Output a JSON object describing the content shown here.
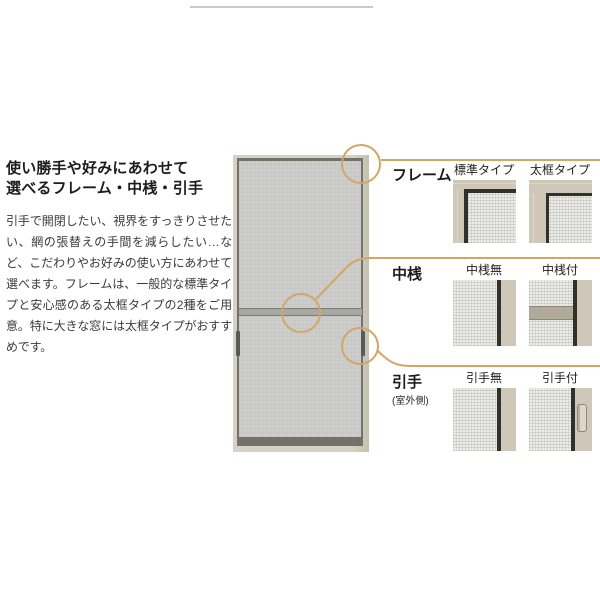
{
  "intro": {
    "title_line1": "使い勝手や好みにあわせて",
    "title_line2": "選べるフレーム・中桟・引手",
    "body": "引手で開閉したい、視界をすっきりさせたい、網の張替えの手間を減らしたい…など、こだわりやお好みの使い方にあわせて選べます。フレームは、一般的な標準タイプと安心感のある太框タイプの2種をご用意。特に大きな窓には太框タイプがおすすめです。"
  },
  "options": {
    "rows": [
      {
        "label": "フレーム",
        "note": "",
        "captions": [
          "標準タイプ",
          "太框タイプ"
        ]
      },
      {
        "label": "中桟",
        "note": "",
        "captions": [
          "中桟無",
          "中桟付"
        ]
      },
      {
        "label": "引手",
        "note": "(室外側)",
        "captions": [
          "引手無",
          "引手付"
        ]
      }
    ]
  },
  "colors": {
    "accent_line": "#d4a666",
    "frame_beige": "#d6d1c3",
    "mesh_gray": "#cdcdcc",
    "dark_line": "#72726a",
    "thumb_beige": "#cfc8b8",
    "thumb_black": "#32302b"
  }
}
